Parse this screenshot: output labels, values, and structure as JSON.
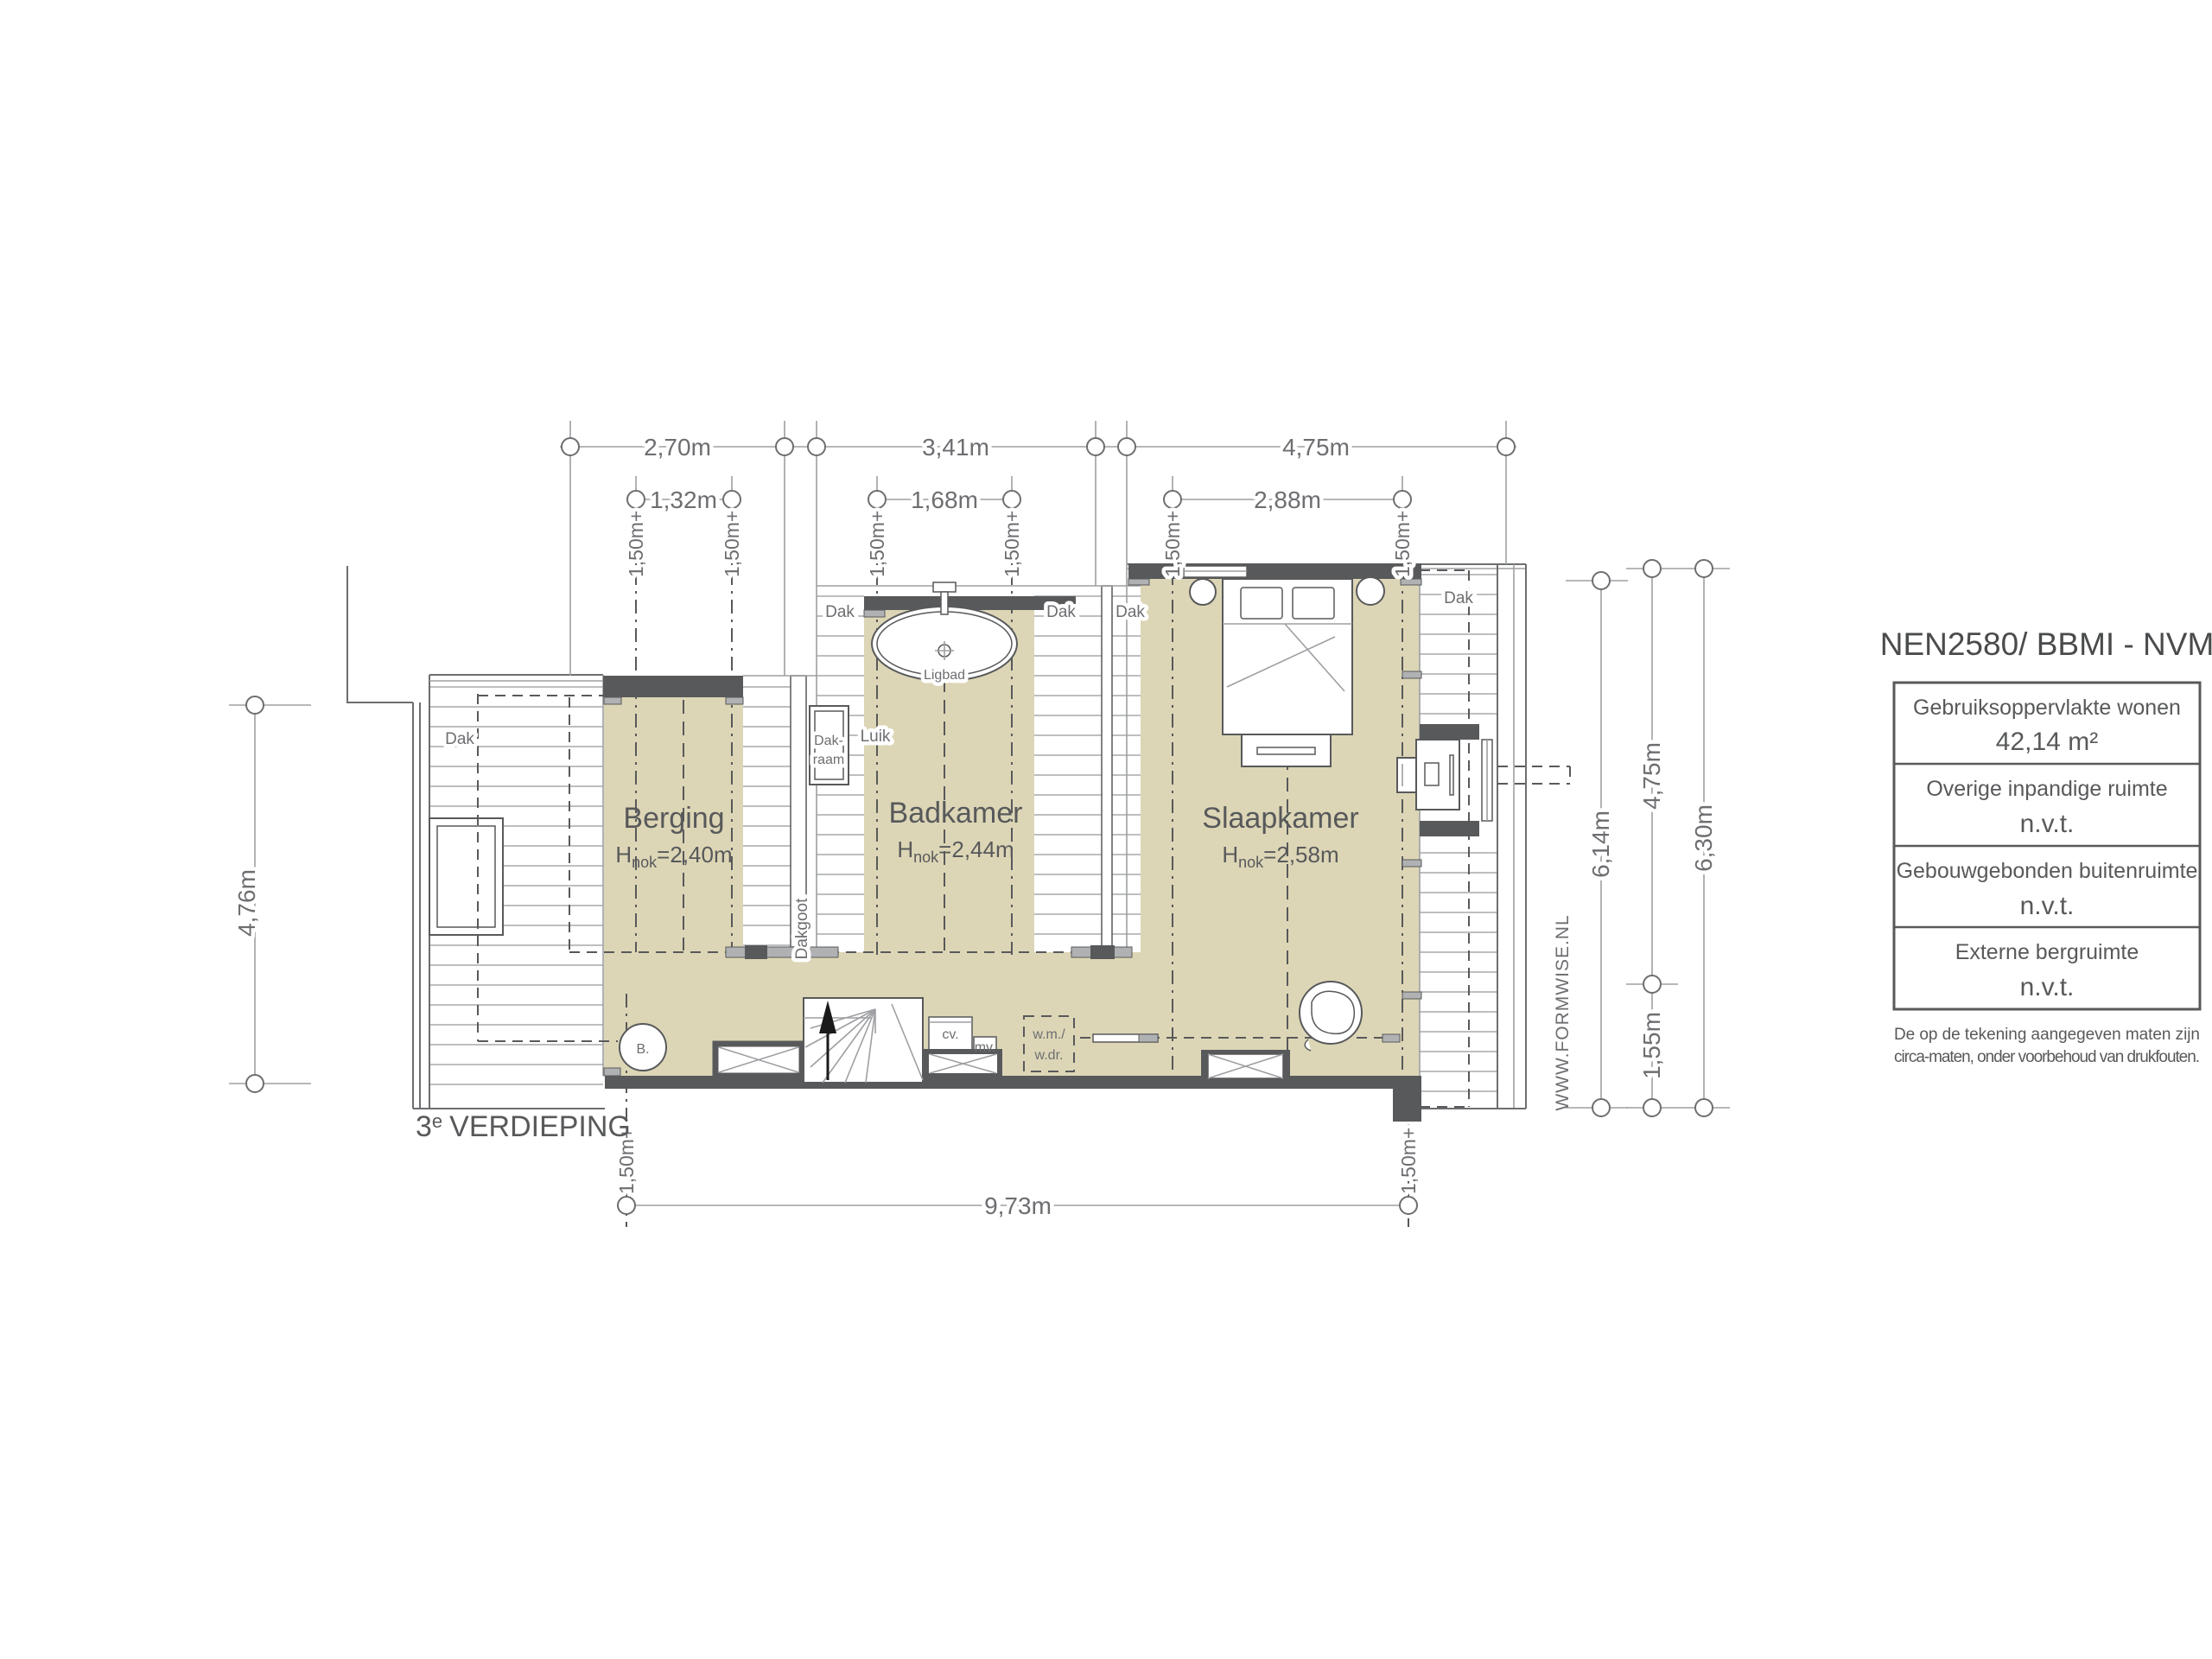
{
  "title": "NEN2580/ BBMI - NVM",
  "legend": {
    "rows": [
      {
        "label": "Gebruiksoppervlakte wonen",
        "value": "42,14 m²"
      },
      {
        "label": "Overige inpandige ruimte",
        "value": "n.v.t."
      },
      {
        "label": "Gebouwgebonden buitenruimte",
        "value": "n.v.t."
      },
      {
        "label": "Externe bergruimte",
        "value": "n.v.t."
      }
    ],
    "disclaimer_line1": "De op de tekening aangegeven maten zijn",
    "disclaimer_line2": "circa-maten, onder voorbehoud van drukfouten."
  },
  "floor_label": {
    "num": "3",
    "sup": "e",
    "name": "VERDIEPING"
  },
  "watermark": "WWW.FORMWISE.NL",
  "rooms": {
    "berging": {
      "name": "Berging",
      "h": "H",
      "h_sub": "nok",
      "h_val": "=2,40m"
    },
    "badkamer": {
      "name": "Badkamer",
      "h": "H",
      "h_sub": "nok",
      "h_val": "=2,44m"
    },
    "slaapkamer": {
      "name": "Slaapkamer",
      "h": "H",
      "h_sub": "nok",
      "h_val": "=2,58m"
    }
  },
  "dims": {
    "top1": [
      "2,70m",
      "3,41m",
      "4,75m"
    ],
    "top2": [
      "1,32m",
      "1,68m",
      "2,88m"
    ],
    "left": "4,76m",
    "right": [
      "6,14m",
      "4,75m",
      "1,55m",
      "6,30m"
    ],
    "bottom": "9,73m",
    "plus": "1,50m+"
  },
  "labels": {
    "dak": "Dak",
    "dakgoot": "Dakgoot",
    "dakraam_1": "Dak-",
    "dakraam_2": "raam",
    "luik": "Luik",
    "ligbad": "Ligbad",
    "boiler": "B.",
    "cv": "cv.",
    "mv": "mv.",
    "wm": "w.m./",
    "wdr": "w.dr."
  },
  "colors": {
    "room_fill": "#dcd6b6",
    "wall_dark": "#58595b",
    "wall_light": "#b0b1b3",
    "line": "#6d6e71",
    "hatch": "#a7a9ac",
    "text": "#6d6e71"
  }
}
